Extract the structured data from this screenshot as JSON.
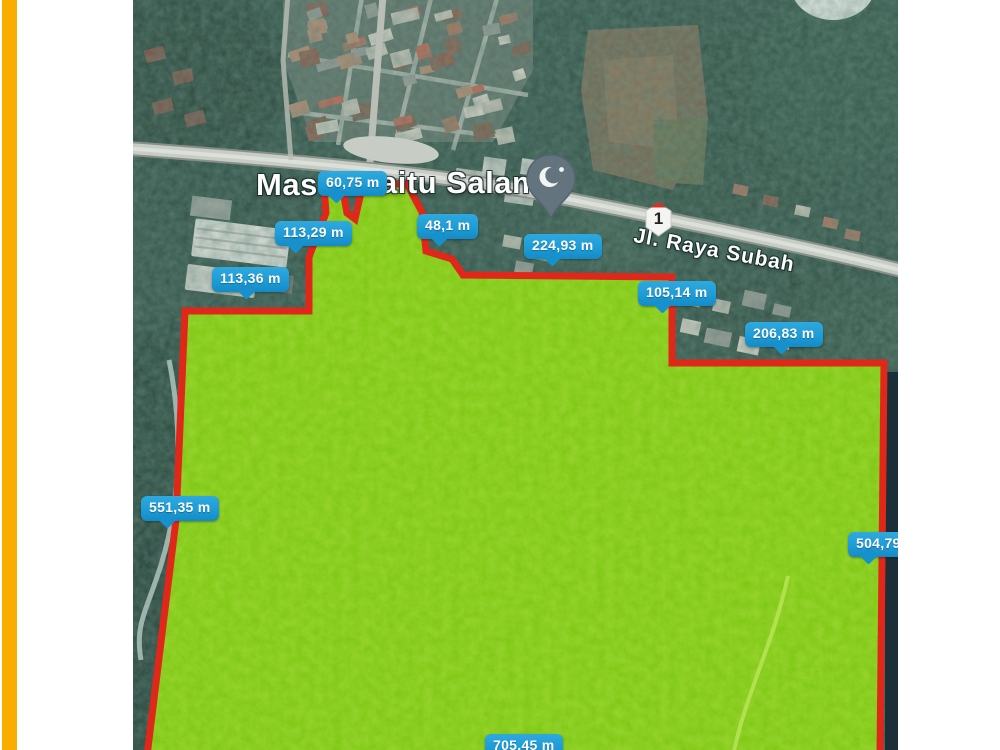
{
  "window": {
    "background_color": "#ffffff",
    "accent_bar_color": "#F9AD00"
  },
  "map": {
    "place": {
      "visible_left": "Mas",
      "visible_right": "aitu Salam"
    },
    "road": {
      "name": "Jl. Raya Subah",
      "route_number": "1"
    },
    "mosque_pin": {
      "icon": "crescent-and-star-icon",
      "color": "#64747E"
    },
    "plot": {
      "fill_color": "#76C40D",
      "border_color": "#E0281A"
    },
    "badge_style": {
      "background": "#1E9CD6",
      "text_color": "#FFFFFF"
    },
    "measurements": [
      {
        "label": "60,75 m",
        "x": 185,
        "y": 171,
        "tail": 12
      },
      {
        "label": "113,29 m",
        "x": 142,
        "y": 221,
        "tail": 14
      },
      {
        "label": "113,36 m",
        "x": 79,
        "y": 267,
        "tail": 28
      },
      {
        "label": "48,1 m",
        "x": 284,
        "y": 214,
        "tail": 16
      },
      {
        "label": "224,93 m",
        "x": 391,
        "y": 234,
        "tail": 22
      },
      {
        "label": "105,14 m",
        "x": 505,
        "y": 281,
        "tail": 18
      },
      {
        "label": "206,83 m",
        "x": 612,
        "y": 322,
        "tail": 30
      },
      {
        "label": "551,35 m",
        "x": 8,
        "y": 496,
        "tail": 20
      },
      {
        "label": "504,79",
        "x": 715,
        "y": 532,
        "tail": 14
      },
      {
        "label": "705,45 m",
        "x": 352,
        "y": 734,
        "tail": 20
      }
    ]
  }
}
